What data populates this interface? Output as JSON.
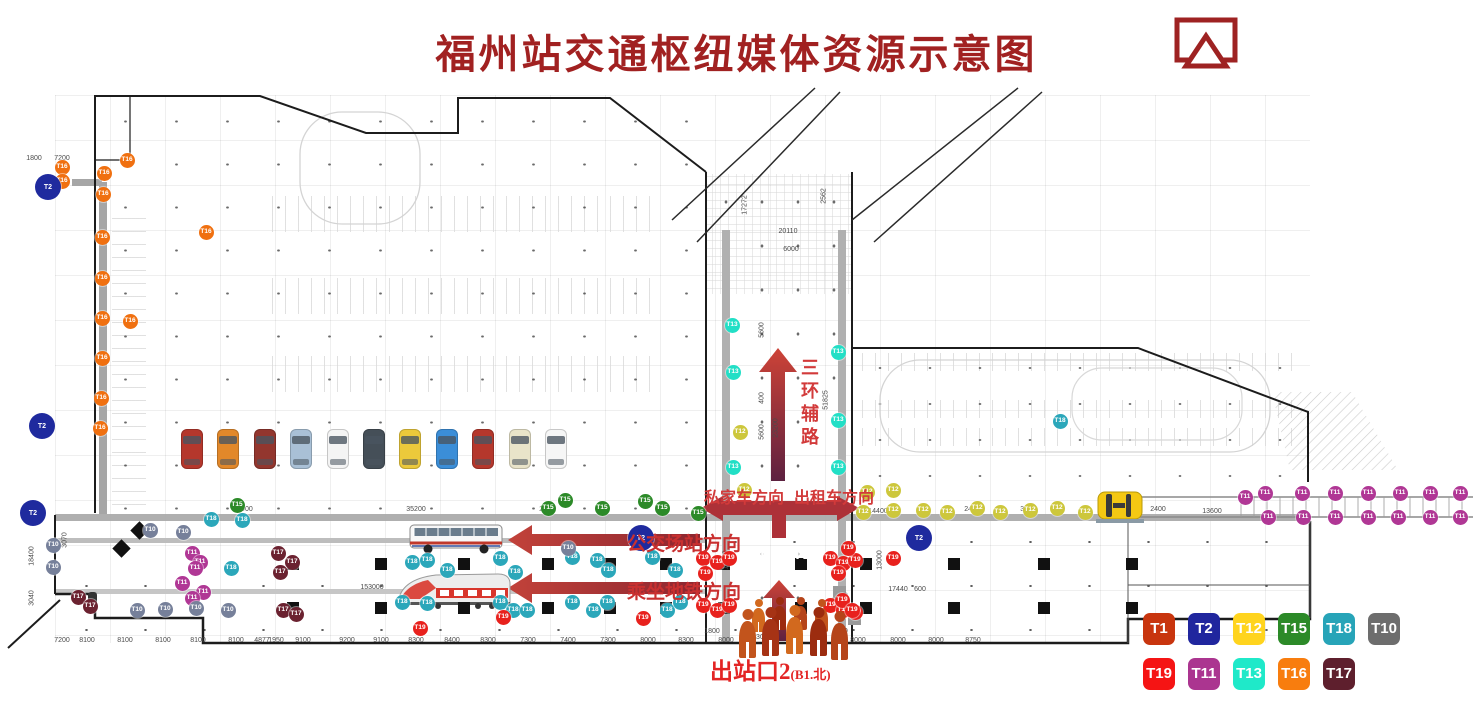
{
  "title": "福州站交通枢纽媒体资源示意图",
  "header_icon": "cast-screen-icon",
  "labels": {
    "private_car": "私家车方向",
    "taxi": "出租车方向",
    "bus_station": "公交场站方向",
    "metro": "乘坐地铁方向",
    "ring_road": "三环辅路",
    "exit_main": "出站口2",
    "exit_sub": "(B1.北)"
  },
  "t1_boxes": [
    "T1",
    "T1"
  ],
  "legend": {
    "rows": [
      [
        {
          "code": "T1",
          "color": "#c8350e"
        },
        {
          "code": "T2",
          "color": "#20269e"
        },
        {
          "code": "T12",
          "color": "#ffd41e"
        },
        {
          "code": "T15",
          "color": "#2c8a28"
        },
        {
          "code": "T18",
          "color": "#27a4b8"
        },
        {
          "code": "T10",
          "color": "#6d6d6d"
        }
      ],
      [
        {
          "code": "T19",
          "color": "#f51414"
        },
        {
          "code": "T11",
          "color": "#ab3590"
        },
        {
          "code": "T13",
          "color": "#1fe9c9"
        },
        {
          "code": "T16",
          "color": "#f87d0e"
        },
        {
          "code": "T17",
          "color": "#5e1f2d"
        }
      ]
    ]
  },
  "marker_colors": {
    "T1": "#c8350e",
    "T2": "#1f2a9e",
    "T12": "#cdc73c",
    "T15": "#2c8a28",
    "T18": "#2ba7ba",
    "T10": "#76809a",
    "T19": "#e8211d",
    "T11": "#b03795",
    "T13": "#22dfc6",
    "T16": "#f07010",
    "T17": "#6b2230"
  },
  "markers": [
    {
      "t": "T16",
      "x": 62,
      "y": 167
    },
    {
      "t": "T16",
      "x": 62,
      "y": 181
    },
    {
      "t": "T16",
      "x": 127,
      "y": 160
    },
    {
      "t": "T16",
      "x": 104,
      "y": 173
    },
    {
      "t": "T16",
      "x": 103,
      "y": 194
    },
    {
      "t": "T16",
      "x": 102,
      "y": 237
    },
    {
      "t": "T16",
      "x": 102,
      "y": 278
    },
    {
      "t": "T16",
      "x": 102,
      "y": 318
    },
    {
      "t": "T16",
      "x": 102,
      "y": 358
    },
    {
      "t": "T16",
      "x": 101,
      "y": 398
    },
    {
      "t": "T16",
      "x": 100,
      "y": 428
    },
    {
      "t": "T16",
      "x": 206,
      "y": 232
    },
    {
      "t": "T16",
      "x": 130,
      "y": 321
    },
    {
      "t": "T13",
      "x": 732,
      "y": 325
    },
    {
      "t": "T13",
      "x": 838,
      "y": 352
    },
    {
      "t": "T13",
      "x": 733,
      "y": 372
    },
    {
      "t": "T13",
      "x": 838,
      "y": 420
    },
    {
      "t": "T13",
      "x": 733,
      "y": 467
    },
    {
      "t": "T13",
      "x": 838,
      "y": 467
    },
    {
      "t": "T18",
      "x": 412,
      "y": 562
    },
    {
      "t": "T18",
      "x": 427,
      "y": 560
    },
    {
      "t": "T18",
      "x": 447,
      "y": 570
    },
    {
      "t": "T18",
      "x": 500,
      "y": 558
    },
    {
      "t": "T18",
      "x": 515,
      "y": 572
    },
    {
      "t": "T18",
      "x": 572,
      "y": 557
    },
    {
      "t": "T18",
      "x": 597,
      "y": 560
    },
    {
      "t": "T18",
      "x": 608,
      "y": 570
    },
    {
      "t": "T18",
      "x": 652,
      "y": 557
    },
    {
      "t": "T18",
      "x": 675,
      "y": 570
    },
    {
      "t": "T18",
      "x": 402,
      "y": 602
    },
    {
      "t": "T18",
      "x": 427,
      "y": 603
    },
    {
      "t": "T18",
      "x": 500,
      "y": 602
    },
    {
      "t": "T18",
      "x": 513,
      "y": 610
    },
    {
      "t": "T18",
      "x": 527,
      "y": 610
    },
    {
      "t": "T18",
      "x": 572,
      "y": 602
    },
    {
      "t": "T18",
      "x": 593,
      "y": 610
    },
    {
      "t": "T18",
      "x": 607,
      "y": 602
    },
    {
      "t": "T18",
      "x": 667,
      "y": 610
    },
    {
      "t": "T18",
      "x": 680,
      "y": 602
    },
    {
      "t": "T18",
      "x": 211,
      "y": 519
    },
    {
      "t": "T18",
      "x": 242,
      "y": 520
    },
    {
      "t": "T18",
      "x": 231,
      "y": 568
    },
    {
      "t": "T18",
      "x": 1060,
      "y": 421
    },
    {
      "t": "T15",
      "x": 548,
      "y": 508
    },
    {
      "t": "T15",
      "x": 565,
      "y": 500
    },
    {
      "t": "T15",
      "x": 602,
      "y": 508
    },
    {
      "t": "T15",
      "x": 645,
      "y": 501
    },
    {
      "t": "T15",
      "x": 662,
      "y": 508
    },
    {
      "t": "T15",
      "x": 698,
      "y": 513
    },
    {
      "t": "T15",
      "x": 237,
      "y": 505
    },
    {
      "t": "T12",
      "x": 740,
      "y": 432
    },
    {
      "t": "T12",
      "x": 744,
      "y": 490
    },
    {
      "t": "T12",
      "x": 867,
      "y": 492
    },
    {
      "t": "T12",
      "x": 893,
      "y": 490
    },
    {
      "t": "T12",
      "x": 863,
      "y": 512
    },
    {
      "t": "T12",
      "x": 893,
      "y": 510
    },
    {
      "t": "T12",
      "x": 923,
      "y": 510
    },
    {
      "t": "T12",
      "x": 947,
      "y": 512
    },
    {
      "t": "T12",
      "x": 977,
      "y": 508
    },
    {
      "t": "T12",
      "x": 1000,
      "y": 512
    },
    {
      "t": "T12",
      "x": 1030,
      "y": 510
    },
    {
      "t": "T12",
      "x": 1057,
      "y": 508
    },
    {
      "t": "T12",
      "x": 1085,
      "y": 512
    },
    {
      "t": "T19",
      "x": 703,
      "y": 558
    },
    {
      "t": "T19",
      "x": 717,
      "y": 562
    },
    {
      "t": "T19",
      "x": 729,
      "y": 558
    },
    {
      "t": "T19",
      "x": 705,
      "y": 573
    },
    {
      "t": "T19",
      "x": 830,
      "y": 558
    },
    {
      "t": "T19",
      "x": 843,
      "y": 563
    },
    {
      "t": "T19",
      "x": 855,
      "y": 560
    },
    {
      "t": "T19",
      "x": 838,
      "y": 573
    },
    {
      "t": "T19",
      "x": 703,
      "y": 605
    },
    {
      "t": "T19",
      "x": 717,
      "y": 610
    },
    {
      "t": "T19",
      "x": 729,
      "y": 605
    },
    {
      "t": "T19",
      "x": 830,
      "y": 605
    },
    {
      "t": "T19",
      "x": 843,
      "y": 610
    },
    {
      "t": "T19",
      "x": 855,
      "y": 612
    },
    {
      "t": "T19",
      "x": 893,
      "y": 558
    },
    {
      "t": "T19",
      "x": 842,
      "y": 600
    },
    {
      "t": "T19",
      "x": 852,
      "y": 610
    },
    {
      "t": "T19",
      "x": 643,
      "y": 618
    },
    {
      "t": "T19",
      "x": 503,
      "y": 617
    },
    {
      "t": "T19",
      "x": 420,
      "y": 628
    },
    {
      "t": "T19",
      "x": 848,
      "y": 548
    },
    {
      "t": "T11",
      "x": 192,
      "y": 553
    },
    {
      "t": "T11",
      "x": 200,
      "y": 562
    },
    {
      "t": "T11",
      "x": 195,
      "y": 568
    },
    {
      "t": "T11",
      "x": 182,
      "y": 583
    },
    {
      "t": "T11",
      "x": 203,
      "y": 592
    },
    {
      "t": "T11",
      "x": 192,
      "y": 598
    },
    {
      "t": "T11",
      "x": 1245,
      "y": 497
    },
    {
      "t": "T11",
      "x": 1265,
      "y": 493
    },
    {
      "t": "T11",
      "x": 1302,
      "y": 493
    },
    {
      "t": "T11",
      "x": 1335,
      "y": 493
    },
    {
      "t": "T11",
      "x": 1368,
      "y": 493
    },
    {
      "t": "T11",
      "x": 1400,
      "y": 493
    },
    {
      "t": "T11",
      "x": 1430,
      "y": 493
    },
    {
      "t": "T11",
      "x": 1460,
      "y": 493
    },
    {
      "t": "T11",
      "x": 1268,
      "y": 517
    },
    {
      "t": "T11",
      "x": 1303,
      "y": 517
    },
    {
      "t": "T11",
      "x": 1335,
      "y": 517
    },
    {
      "t": "T11",
      "x": 1368,
      "y": 517
    },
    {
      "t": "T11",
      "x": 1398,
      "y": 517
    },
    {
      "t": "T11",
      "x": 1430,
      "y": 517
    },
    {
      "t": "T11",
      "x": 1460,
      "y": 517
    },
    {
      "t": "T17",
      "x": 278,
      "y": 553
    },
    {
      "t": "T17",
      "x": 292,
      "y": 562
    },
    {
      "t": "T17",
      "x": 280,
      "y": 572
    },
    {
      "t": "T17",
      "x": 283,
      "y": 610
    },
    {
      "t": "T17",
      "x": 296,
      "y": 614
    },
    {
      "t": "T17",
      "x": 78,
      "y": 597
    },
    {
      "t": "T17",
      "x": 90,
      "y": 606
    },
    {
      "t": "T10",
      "x": 150,
      "y": 530
    },
    {
      "t": "T10",
      "x": 183,
      "y": 532
    },
    {
      "t": "T10",
      "x": 53,
      "y": 545
    },
    {
      "t": "T10",
      "x": 53,
      "y": 567
    },
    {
      "t": "T10",
      "x": 137,
      "y": 610
    },
    {
      "t": "T10",
      "x": 165,
      "y": 609
    },
    {
      "t": "T10",
      "x": 196,
      "y": 608
    },
    {
      "t": "T10",
      "x": 228,
      "y": 610
    },
    {
      "t": "T10",
      "x": 568,
      "y": 548
    },
    {
      "t": "T2",
      "x": 48,
      "y": 187
    },
    {
      "t": "T2",
      "x": 42,
      "y": 426
    },
    {
      "t": "T2",
      "x": 641,
      "y": 538
    },
    {
      "t": "T2",
      "x": 919,
      "y": 538
    },
    {
      "t": "T2",
      "x": 33,
      "y": 513
    }
  ],
  "dimensions": {
    "bottom_y": 637,
    "bottom": [
      {
        "v": "7200",
        "x": 62
      },
      {
        "v": "8100",
        "x": 87
      },
      {
        "v": "8100",
        "x": 125
      },
      {
        "v": "8100",
        "x": 163
      },
      {
        "v": "8100",
        "x": 198
      },
      {
        "v": "8100",
        "x": 236
      },
      {
        "v": "4877",
        "x": 262
      },
      {
        "v": "1950",
        "x": 276
      },
      {
        "v": "9100",
        "x": 303
      },
      {
        "v": "9200",
        "x": 347
      },
      {
        "v": "9100",
        "x": 381
      },
      {
        "v": "8300",
        "x": 416
      },
      {
        "v": "8400",
        "x": 452
      },
      {
        "v": "8300",
        "x": 488
      },
      {
        "v": "7300",
        "x": 528
      },
      {
        "v": "7400",
        "x": 568
      },
      {
        "v": "7300",
        "x": 608
      },
      {
        "v": "8000",
        "x": 648
      },
      {
        "v": "8300",
        "x": 686
      },
      {
        "v": "8000",
        "x": 726
      },
      {
        "v": "8000",
        "x": 858
      },
      {
        "v": "8000",
        "x": 898
      },
      {
        "v": "8000",
        "x": 936
      },
      {
        "v": "8750",
        "x": 973
      }
    ],
    "inline": [
      {
        "v": "1800",
        "x": 34,
        "y": 155
      },
      {
        "v": "7200",
        "x": 62,
        "y": 155
      },
      {
        "v": "20110",
        "x": 788,
        "y": 228
      },
      {
        "v": "6000",
        "x": 791,
        "y": 246
      },
      {
        "v": "17272",
        "x": 745,
        "y": 205,
        "r": 1
      },
      {
        "v": "2562",
        "x": 824,
        "y": 196,
        "r": 1
      },
      {
        "v": "5600",
        "x": 762,
        "y": 330,
        "r": 1
      },
      {
        "v": "400",
        "x": 762,
        "y": 398,
        "r": 1
      },
      {
        "v": "5600",
        "x": 762,
        "y": 432,
        "r": 1
      },
      {
        "v": "23200",
        "x": 776,
        "y": 428,
        "r": 1
      },
      {
        "v": "51825",
        "x": 826,
        "y": 400,
        "r": 1
      },
      {
        "v": "65000",
        "x": 243,
        "y": 506
      },
      {
        "v": "35200",
        "x": 416,
        "y": 506
      },
      {
        "v": "2400",
        "x": 547,
        "y": 506
      },
      {
        "v": "14400",
        "x": 878,
        "y": 508
      },
      {
        "v": "2400",
        "x": 972,
        "y": 506
      },
      {
        "v": "3520",
        "x": 1028,
        "y": 506
      },
      {
        "v": "2400",
        "x": 1158,
        "y": 506
      },
      {
        "v": "13600",
        "x": 1212,
        "y": 508
      },
      {
        "v": "153000",
        "x": 372,
        "y": 584
      },
      {
        "v": "17440",
        "x": 898,
        "y": 586
      },
      {
        "v": "600",
        "x": 920,
        "y": 586
      },
      {
        "v": "13000",
        "x": 726,
        "y": 560,
        "r": 1
      },
      {
        "v": "13000",
        "x": 880,
        "y": 560,
        "r": 1
      },
      {
        "v": "18400",
        "x": 32,
        "y": 556,
        "r": 1
      },
      {
        "v": "3040",
        "x": 32,
        "y": 598,
        "r": 1
      },
      {
        "v": "3070",
        "x": 65,
        "y": 540,
        "r": 1
      },
      {
        "v": "1800",
        "x": 712,
        "y": 628
      },
      {
        "v": "1800",
        "x": 840,
        "y": 628
      },
      {
        "v": "2750",
        "x": 846,
        "y": 600,
        "r": 1
      },
      {
        "v": "930",
        "x": 758,
        "y": 634
      }
    ]
  },
  "cars": [
    "#b5372c",
    "#e2882a",
    "#93362e",
    "#a9c0d6",
    "#f4f4f4",
    "#454f58",
    "#ecc93b",
    "#3b8ed8",
    "#b5372c",
    "#e9e4c9",
    "#f6f6f6"
  ]
}
